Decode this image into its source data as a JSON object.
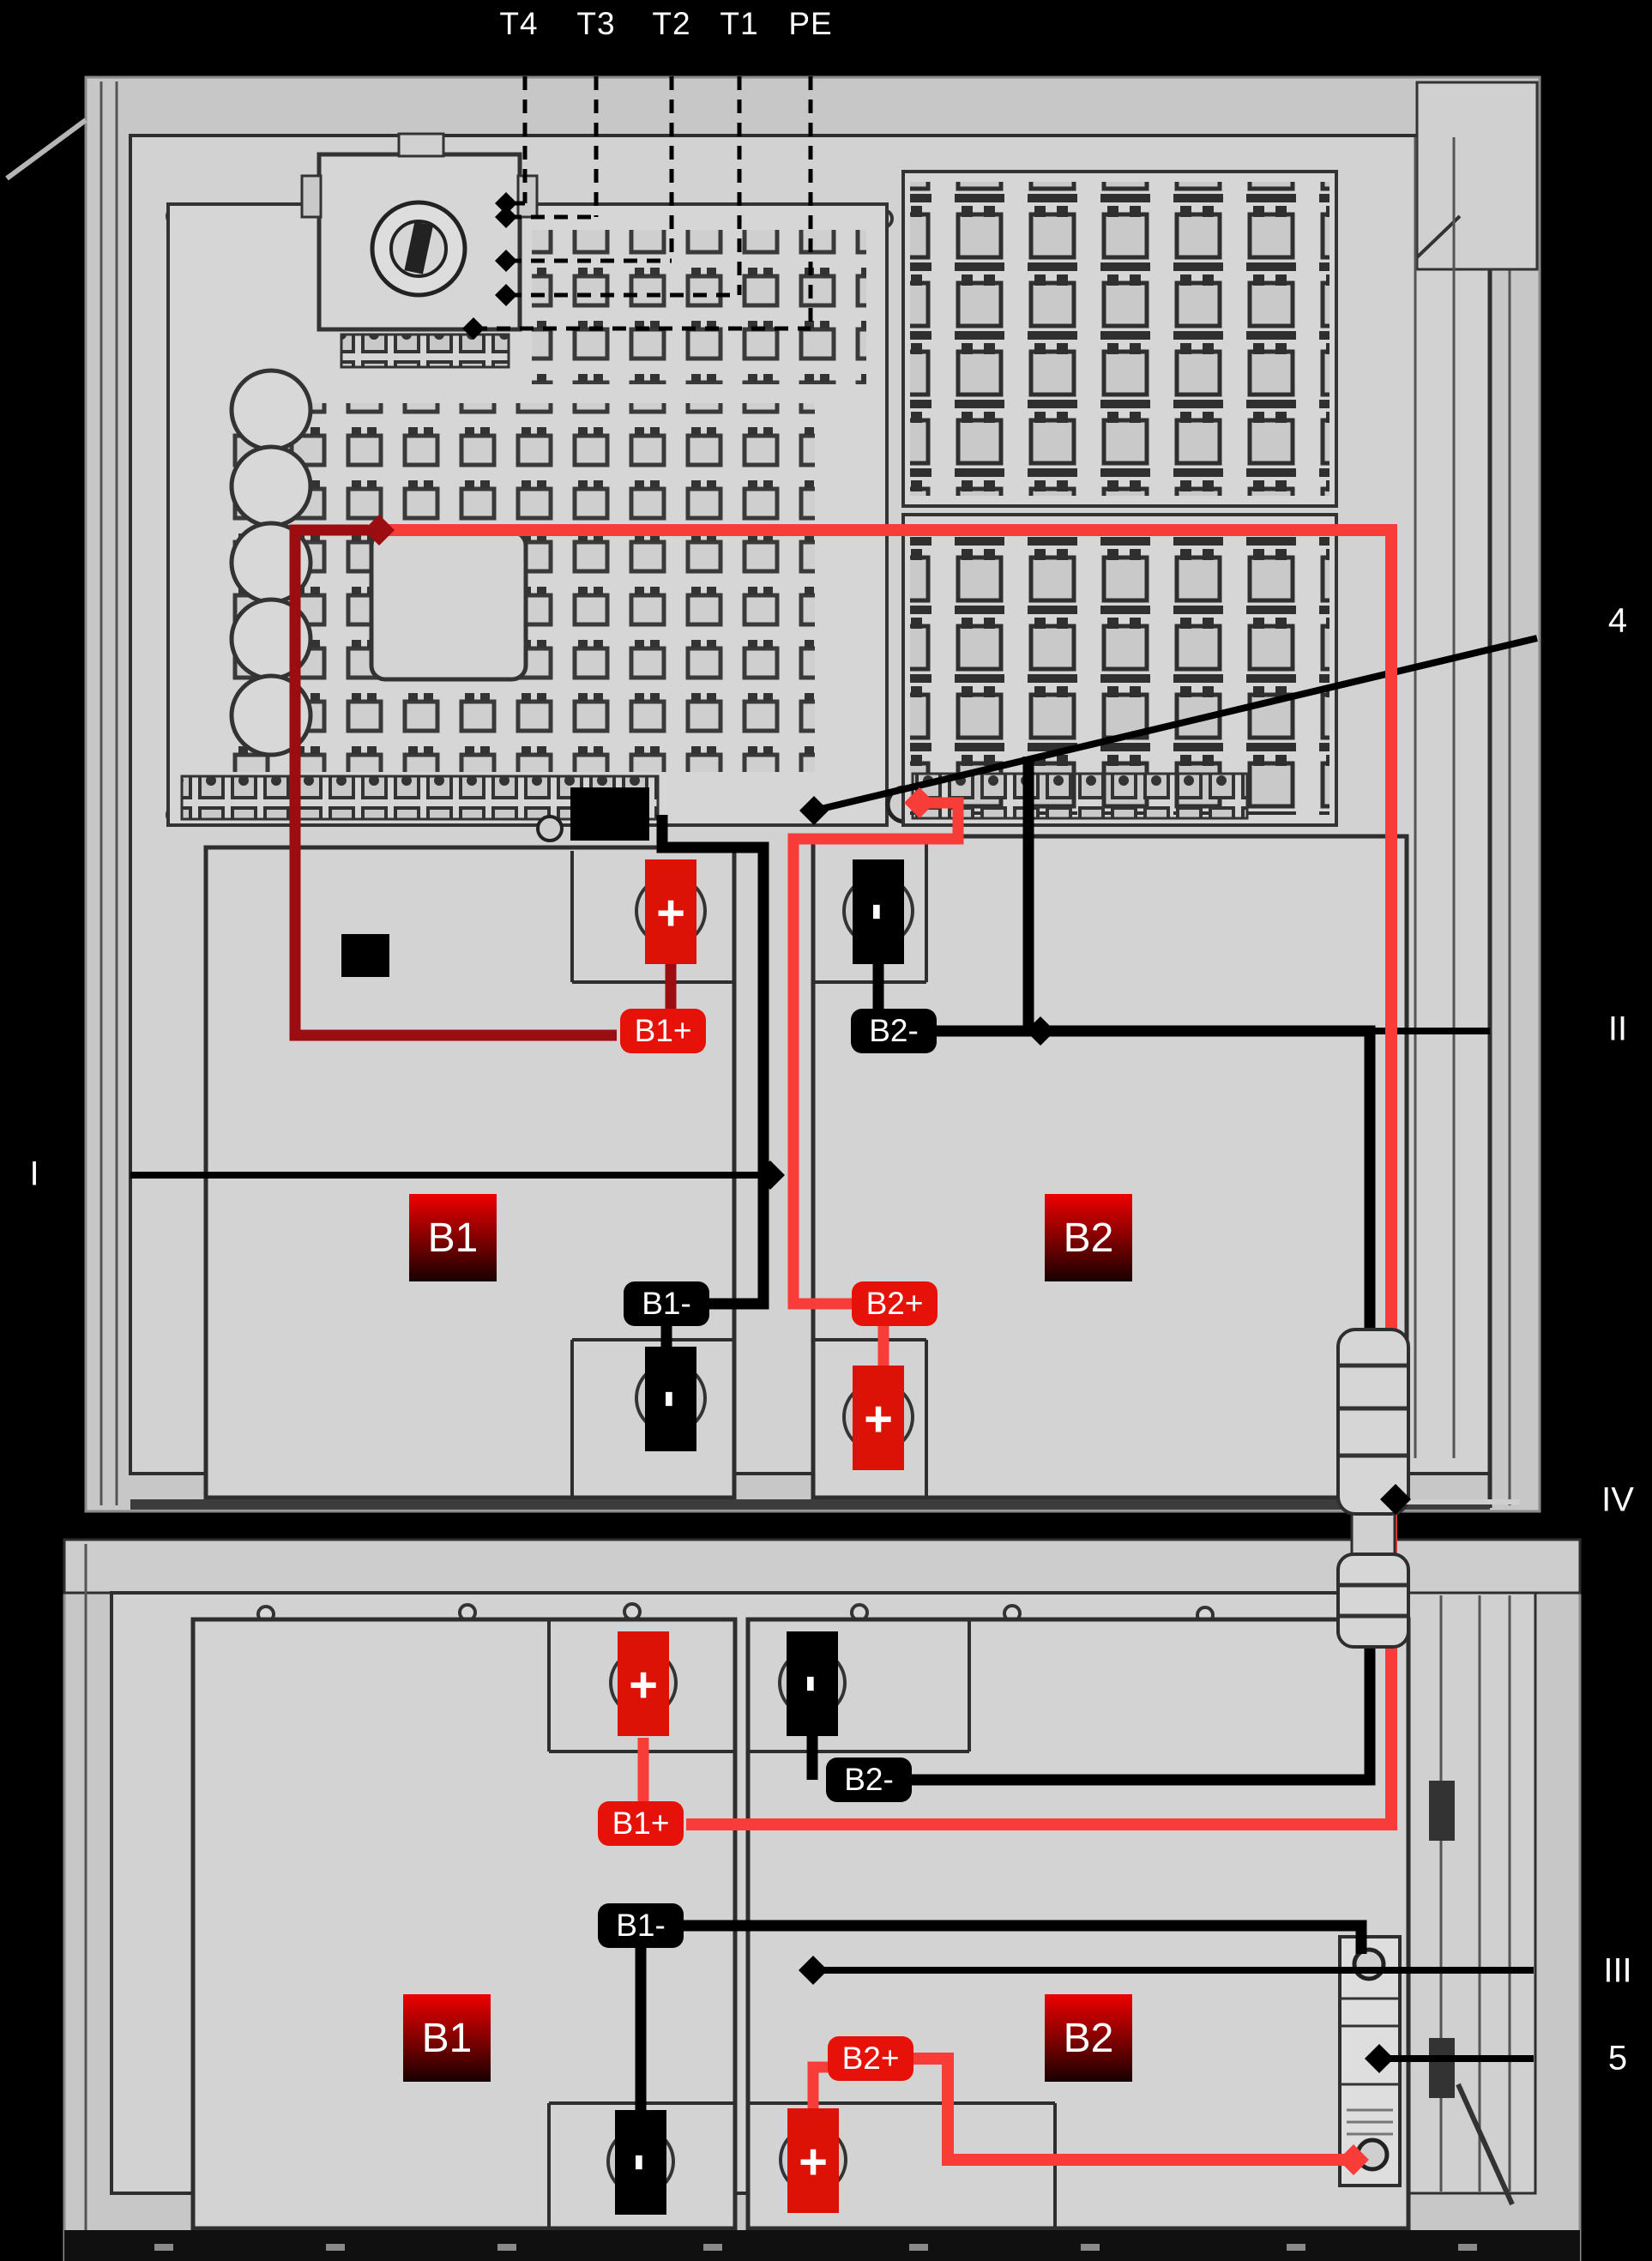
{
  "colors": {
    "background": "#000000",
    "cabinet_fill": "#d2d2d2",
    "outline": "#2e2e2e",
    "wire_black": "#000000",
    "wire_red_bright": "#f83c38",
    "wire_red_dark": "#9b0d10",
    "tag_red": "#e61209",
    "tag_black": "#000000",
    "label_text": "#ffffff"
  },
  "top_terminal_labels": {
    "t4": "T4",
    "t3": "T3",
    "t2": "T2",
    "t1": "T1",
    "pe": "PE"
  },
  "callouts": {
    "item_4": "4",
    "item_I": "I",
    "item_II": "II",
    "item_III": "III",
    "item_IV": "IV",
    "item_5": "5"
  },
  "cabinet_top": {
    "battery_b1": "B1",
    "battery_b2": "B2",
    "tag_b1_plus": "B1+",
    "tag_b2_minus": "B2-",
    "tag_b1_minus": "B1-",
    "tag_b2_plus": "B2+",
    "sign_b1_plus": "+",
    "sign_b2_minus": "-",
    "sign_b1_minus": "-",
    "sign_b2_plus": "+"
  },
  "cabinet_bottom": {
    "battery_b1": "B1",
    "battery_b2": "B2",
    "tag_b1_plus": "B1+",
    "tag_b2_minus": "B2-",
    "tag_b1_minus": "B1-",
    "tag_b2_plus": "B2+",
    "sign_b1_plus": "+",
    "sign_b2_minus": "-",
    "sign_b1_minus": "-",
    "sign_b2_plus": "+"
  }
}
